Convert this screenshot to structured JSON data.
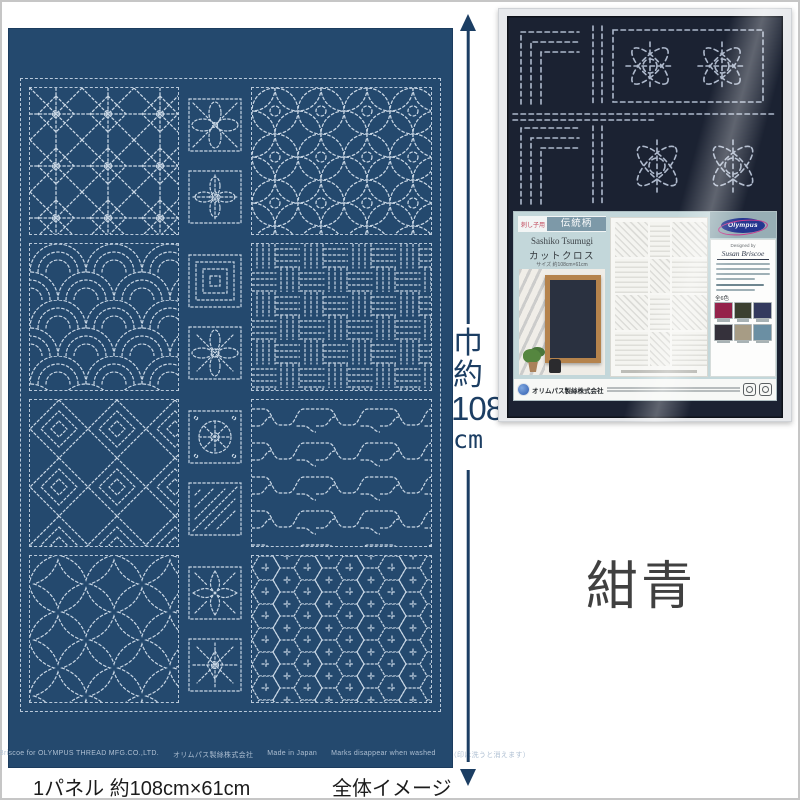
{
  "fabric": {
    "base_color": "#24496e",
    "stitch_color": "#c9d7e5",
    "selvage": {
      "designed_by": "Designed by Susan Briscoe for OLYMPUS THREAD MFG.CO.,LTD.",
      "company": "オリムパス製絲株式会社",
      "made_in": "Made in Japan",
      "wash_note": "Marks disappear when washed",
      "wash_note_jp": "（印は洗うと消えます）"
    },
    "pattern_names": {
      "large": [
        "asanoha-stars",
        "shippo-circles",
        "nowaki-arcs",
        "basket-weave",
        "nested-diamonds",
        "meander",
        "fundo-curves",
        "kikko-hexagons"
      ],
      "small": [
        "four-petal-flower",
        "cross-flower",
        "spiral-squares",
        "eight-petal-flower",
        "hana-circle",
        "nested-triangles",
        "leaf-cross",
        "eight-point-star"
      ]
    }
  },
  "measurement": {
    "char1": "巾",
    "char2": "約",
    "number": "108",
    "unit": "cm"
  },
  "captions": {
    "panel_size": "1パネル 約108cm×61cm",
    "overall_image": "全体イメージ"
  },
  "color_name": {
    "text": "紺青"
  },
  "package": {
    "label": {
      "badge_prefix": "刺し子用",
      "badge_title": "伝統柄",
      "title_en": "Sashiko Tsumugi",
      "title_jp": "カットクロス",
      "size_line": "サイズ 約108cm×61cm",
      "brand": "Olympus",
      "designed_by": "Designed by",
      "designer": "Susan Briscoe",
      "colors_count": "全6色",
      "company": "オリムパス製絲株式会社",
      "swatches": [
        {
          "style": "background:#95224a"
        },
        {
          "style": "background:#3c4030"
        },
        {
          "style": "background:#333a5e"
        },
        {
          "style": "background:#35313b"
        },
        {
          "style": "background:#a79c85"
        },
        {
          "style": "background:#6b8fa3"
        }
      ]
    }
  }
}
